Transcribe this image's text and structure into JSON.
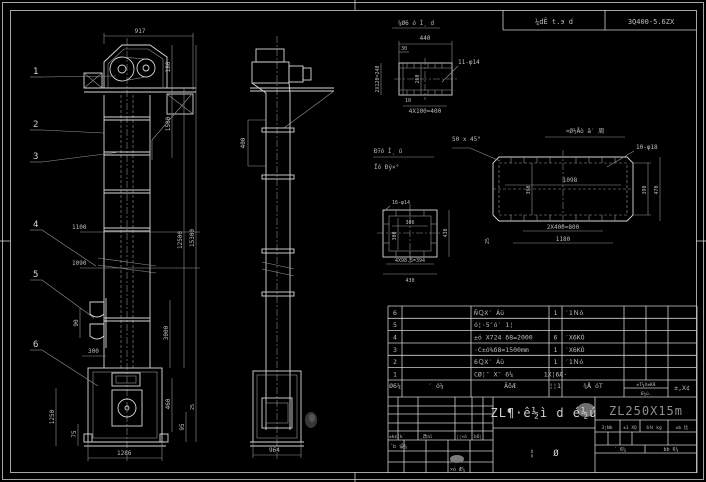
{
  "colors": {
    "background": "#000000",
    "line": "#d9d9d9",
    "dim_line": "#969696",
    "text": "#bdbdbd",
    "model_text": "#8f8f8f"
  },
  "header_strip": {
    "left": "¼dÊ t.э d",
    "right": "3Q400-5.6ZX"
  },
  "front": {
    "balloons": [
      "1",
      "2",
      "3",
      "4",
      "5",
      "6"
    ],
    "dims": {
      "d917": "917",
      "d180": "180",
      "d1500": "1500",
      "d12500": "12500",
      "d15300": "15300",
      "d3000": "3000",
      "d1100": "1100",
      "d1090": "1090",
      "d90": "90",
      "d300": "300",
      "d1250": "1250",
      "d75": "75",
      "d1286": "1286",
      "d460": "460",
      "d95": "95",
      "d25": "25"
    }
  },
  "side": {
    "dims": {
      "d400": "400",
      "d964": "964"
    }
  },
  "channel": {
    "title": "¼Ø6 ó Ì¸ d",
    "dims": {
      "d440": "440",
      "d30": "30",
      "d18": "18",
      "left": "2X120=240",
      "inner": "260",
      "holes": "11-φ14",
      "pitch": "4X100=400"
    }
  },
  "flange": {
    "label1": "Ðｦó Ì¸ ú",
    "label2": "Ïó Ðý×°",
    "dims": {
      "holes": "16-φ14",
      "w": "306",
      "h": "300",
      "right": "430",
      "pitch": "4X98.5=394",
      "width": "430"
    }
  },
  "plate": {
    "title": "¤Ø½Åò ā′ 周",
    "chamfer": "50 x 45°",
    "dims": {
      "holes": "10-φ18",
      "inner_w": "1098",
      "inner_h": "390",
      "right_h": "390",
      "outer_h": "470",
      "pitch": "2X400=800",
      "width": "1180",
      "edge": "25"
    }
  },
  "bom": {
    "rows": [
      {
        "no": "6",
        "code": "",
        "name": "ÑＱX′ Áü",
        "qty": "1",
        "material": "′1Ｎó",
        "weight_each": "",
        "weight_total": "",
        "note": ""
      },
      {
        "no": "5",
        "code": "",
        "name": "ó¦·5″ó′ 1¦",
        "qty": "",
        "material": "",
        "weight_each": "",
        "weight_total": "",
        "note": ""
      },
      {
        "no": "4",
        "code": "",
        "name": "±ó X724 δ8=2000",
        "qty": "6",
        "material": "′X6KÓ",
        "weight_each": "",
        "weight_total": "",
        "note": ""
      },
      {
        "no": "3",
        "code": "",
        "name": "·C±ó%δ8=1500mm",
        "qty": "1",
        "material": "′X6KÓ",
        "weight_each": "",
        "weight_total": "",
        "note": ""
      },
      {
        "no": "2",
        "code": "",
        "name": "6ＱX′ Áü",
        "qty": "1",
        "material": "′1Ｎó",
        "weight_each": "",
        "weight_total": "",
        "note": ""
      },
      {
        "no": "1",
        "code": "",
        "name": "CØ¦″ X″ 6¼",
        "qty": "1X¦6Æ·",
        "material": "",
        "weight_each": "",
        "weight_total": "",
        "note": ""
      }
    ],
    "headers": {
      "no": "Ø6¼",
      "code": "′ ó¼",
      "name": "ÃõÆ",
      "qty": "¦¦1",
      "material": "¾Å óT",
      "weight": "±T¼X±KÆ",
      "weight_sub": "6¼ú.",
      "note": "±,X¢"
    }
  },
  "titleblock": {
    "title": "ZL¶·ê½ì d é½ú",
    "model": "ZL250X15m",
    "stage": [
      "3¦Nb",
      "±1 XQ",
      "6Ｎ kg",
      "±b 比"
    ],
    "sheet": [
      "′  6¼",
      "bb  6¼"
    ],
    "marks": [
      "¦",
      "Ø"
    ],
    "rev": [
      "±k¢(k′",
      "¸改al",
      "¦¦×ó",
      "bÓ¦"
    ],
    "designer": "′b 设¼",
    "approver": "×ó Æ¼"
  }
}
